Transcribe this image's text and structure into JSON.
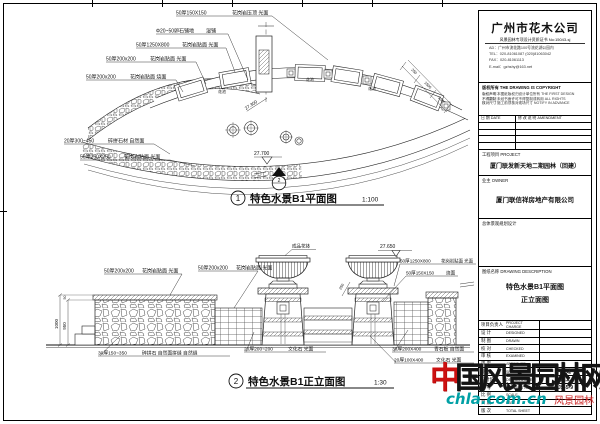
{
  "plan": {
    "callouts": [
      {
        "spec": "50厚150X150",
        "mat": "花岗岩压顶 光面"
      },
      {
        "spec": "Φ20~50卵石铺地",
        "mat": "湿铺"
      },
      {
        "spec": "50厚1250X800",
        "mat": "花岗岩贴面 光面"
      },
      {
        "spec": "50厚200x200",
        "mat": "花岗岩贴面 光面"
      },
      {
        "spec": "50厚200x200",
        "mat": "花岗岩贴面 烧面"
      },
      {
        "spec": "20厚300~450",
        "mat": "碎拼石材 自然面"
      },
      {
        "spec": "50厚250X250",
        "mat": "花岗岩贴面 光面"
      }
    ],
    "labels": {
      "elev_top": "27.700",
      "elev_side": "27.300",
      "section_no": "2",
      "planter": "花池"
    },
    "dims": [
      "250",
      "1500",
      "250"
    ],
    "caption": {
      "num": "1",
      "title": "特色水景B1平面图",
      "scale": "1:100"
    }
  },
  "elevation": {
    "callouts_top": [
      {
        "spec": "50厚200x200",
        "mat": "花岗岩贴面 光面"
      },
      {
        "spec": "50厚200x200",
        "mat": "花岗岩贴面 光面"
      }
    ],
    "callouts_right": [
      {
        "spec": "50厚1250X800",
        "mat": "花岗岩贴面 光面"
      },
      {
        "spec": "50厚150X150",
        "mat": "烧面"
      }
    ],
    "callouts_bottom": [
      {
        "spec": "30厚150~350",
        "mat": "碎拼石 自然面拼缝 自然缝"
      },
      {
        "spec": "20厚200~200",
        "mat": "文化石 光面"
      },
      {
        "spec": "30厚200X400",
        "mat": "青石板 自然面"
      },
      {
        "spec": "20厚100X400",
        "mat": "文化石 光面"
      }
    ],
    "labels": {
      "urn": "成品花钵",
      "elev_mark": "27.650",
      "dim": "250"
    },
    "dims": {
      "d50": "50",
      "d950": "950",
      "d1000": "1000"
    },
    "caption": {
      "num": "2",
      "title": "特色水景B1正立面图",
      "scale": "1:30"
    }
  },
  "titleblock": {
    "company": "广州市花木公司",
    "cert": "风景园林专项设计资质证书 No:15043-sj",
    "addr": [
      "AD：广州市流花路100号流花湖公园内",
      "TEL：020-81061087  (020)81063042",
      "FAX：020-81061113",
      "E-mail：gzhshy@163.net"
    ],
    "copyright_title": "版权所有  THE DRAWING IS COPYRIGHT",
    "copyright_rows": [
      {
        "l": "版权声明",
        "r": "本图纸版权归设计单位所有 THE FIRST DESIGN"
      },
      {
        "l": "不得翻制",
        "r": "未经书面许可不得复制或转用 ALL RIGHTS"
      },
      {
        "l": "核对尺寸",
        "r": "施工前须核对现场尺寸 NOTIFY IN ADVANCE"
      }
    ],
    "rev_date": "日 期  DATE",
    "rev_amend": "修 改 说 明  AMENDMENT",
    "project_label": "工程项目  PROJECT",
    "project_name": "厦门联发新天地二期园林（回建）",
    "owner_label": "业主  OWNER",
    "owner_name": "厦门联信祥房地产有限公司",
    "planning_label": "总体景观规划设计",
    "desc_label": "图纸名称  DRAWING DESCRIPTION",
    "desc_line1": "特色水景B1平面图",
    "desc_line2": "正立面图",
    "sign_rows": [
      {
        "cn": "项目负责人",
        "en": "PROJECT CHARGE",
        "val": ""
      },
      {
        "cn": "设 计",
        "en": "DESIGNED",
        "val": ""
      },
      {
        "cn": "制 图",
        "en": "DRAWN",
        "val": ""
      },
      {
        "cn": "校 对",
        "en": "CHECKED",
        "val": ""
      },
      {
        "cn": "审 核",
        "en": "EXAMINED",
        "val": ""
      },
      {
        "cn": "审 定",
        "en": "APPROVED",
        "val": ""
      },
      {
        "cn": "专 业",
        "en": "SPECIALTY",
        "val": "园 建"
      },
      {
        "cn": "设计阶段",
        "en": "DESIGN STAGE",
        "val": "施工"
      },
      {
        "cn": "图 号",
        "en": "DRAWING NO.",
        "val": "JS-5-9"
      },
      {
        "cn": "比 例",
        "en": "SCALE",
        "val": ""
      },
      {
        "cn": "日 期",
        "en": "DATE",
        "val": ""
      },
      {
        "cn": "版 次",
        "en": "TOTAL SHEET",
        "val": ""
      }
    ]
  },
  "watermark": {
    "chars": [
      "中",
      "国",
      "风",
      "景",
      "园",
      "林",
      "网"
    ],
    "domain": "chla.com.cn",
    "seal_text": "风景园林",
    "seal": "■"
  },
  "colors": {
    "paper": "#ffffff",
    "line": "#1a1a1a",
    "watermark_red": "#cc1111",
    "watermark_teal": "#00a0a5"
  }
}
